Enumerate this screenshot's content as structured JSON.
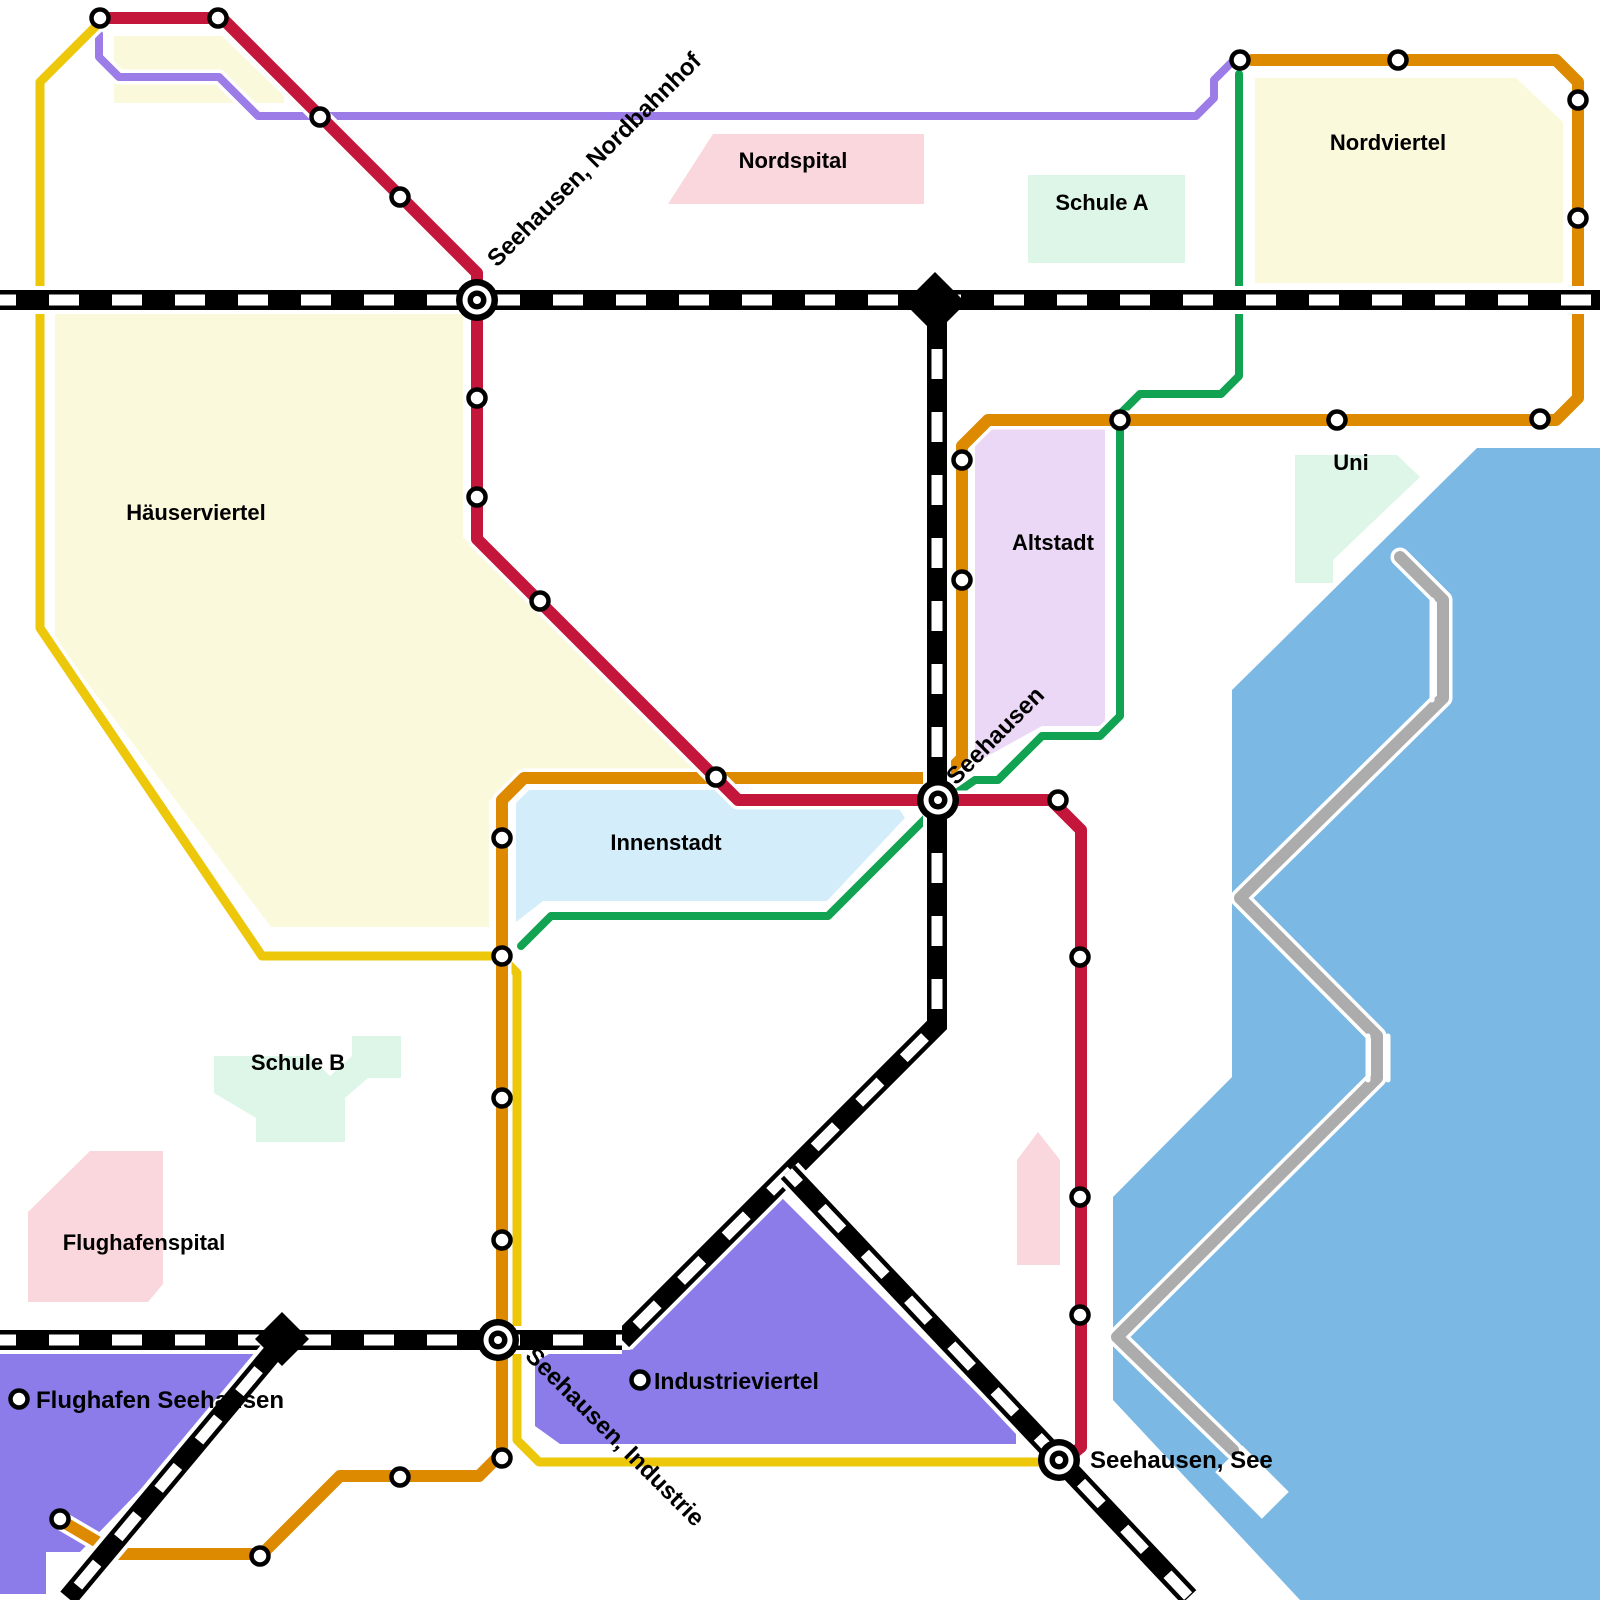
{
  "map": {
    "colors": {
      "line_red": "#C4153A",
      "line_orange": "#DE8A00",
      "line_yellow": "#EDC70A",
      "line_green": "#12A352",
      "line_purple": "#9C7DE8",
      "line_gray": "#ACACAC",
      "railway": "#000000",
      "lake": "#7BB8E3",
      "district_yellow": "#FBF9DC",
      "hospital_pink": "#F9D7DC",
      "school_mint": "#DEF6E8",
      "altstadt_lavender": "#EBD7F6",
      "innenstadt_blue": "#D3EDFA",
      "industrial_violet": "#8B7CEA"
    },
    "regions": [
      {
        "id": "haeuserviertel",
        "label": "Häuserviertel",
        "fill": "district_yellow",
        "label_x": 196,
        "label_y": 520,
        "points": [
          [
            55,
            312
          ],
          [
            463,
            312
          ],
          [
            463,
            537
          ],
          [
            697,
            771
          ],
          [
            697,
            779
          ],
          [
            516,
            779
          ],
          [
            489,
            801
          ],
          [
            489,
            927
          ],
          [
            271,
            927
          ],
          [
            55,
            640
          ]
        ]
      },
      {
        "id": "nordwest-block",
        "label": "",
        "fill": "district_yellow",
        "points": [
          [
            114,
            36
          ],
          [
            222,
            36
          ],
          [
            284,
            96
          ],
          [
            284,
            103
          ],
          [
            114,
            103
          ]
        ]
      },
      {
        "id": "nordviertel",
        "label": "Nordviertel",
        "fill": "district_yellow",
        "label_x": 1388,
        "label_y": 150,
        "points": [
          [
            1255,
            78
          ],
          [
            1516,
            78
          ],
          [
            1563,
            122
          ],
          [
            1563,
            283
          ],
          [
            1255,
            283
          ]
        ]
      },
      {
        "id": "nordspital",
        "label": "Nordspital",
        "fill": "hospital_pink",
        "label_x": 793,
        "label_y": 168,
        "points": [
          [
            713,
            134
          ],
          [
            924,
            134
          ],
          [
            924,
            204
          ],
          [
            668,
            204
          ]
        ]
      },
      {
        "id": "schule-a",
        "label": "Schule A",
        "fill": "school_mint",
        "label_x": 1102,
        "label_y": 210,
        "points": [
          [
            1028,
            175
          ],
          [
            1185,
            175
          ],
          [
            1185,
            263
          ],
          [
            1028,
            263
          ]
        ]
      },
      {
        "id": "uni",
        "label": "Uni",
        "fill": "school_mint",
        "label_x": 1351,
        "label_y": 470,
        "points": [
          [
            1295,
            455
          ],
          [
            1397,
            455
          ],
          [
            1420,
            477
          ],
          [
            1333,
            560
          ],
          [
            1333,
            583
          ],
          [
            1295,
            583
          ]
        ]
      },
      {
        "id": "altstadt",
        "label": "Altstadt",
        "fill": "altstadt_lavender",
        "label_x": 1053,
        "label_y": 550,
        "points": [
          [
            975,
            428
          ],
          [
            1105,
            428
          ],
          [
            1105,
            726
          ],
          [
            1042,
            726
          ],
          [
            975,
            763
          ]
        ]
      },
      {
        "id": "innenstadt",
        "label": "Innenstadt",
        "fill": "innenstadt_blue",
        "label_x": 666,
        "label_y": 850,
        "points": [
          [
            529,
            790
          ],
          [
            725,
            790
          ],
          [
            740,
            807
          ],
          [
            898,
            807
          ],
          [
            905,
            818
          ],
          [
            827,
            901
          ],
          [
            543,
            901
          ],
          [
            516,
            922
          ],
          [
            516,
            803
          ]
        ]
      },
      {
        "id": "schule-b",
        "label": "Schule B",
        "fill": "school_mint",
        "label_x": 298,
        "label_y": 1070,
        "points": [
          [
            214,
            1056
          ],
          [
            310,
            1056
          ],
          [
            330,
            1076
          ],
          [
            352,
            1056
          ],
          [
            352,
            1036
          ],
          [
            401,
            1036
          ],
          [
            401,
            1078
          ],
          [
            368,
            1078
          ],
          [
            345,
            1098
          ],
          [
            345,
            1142
          ],
          [
            256,
            1142
          ],
          [
            256,
            1118
          ],
          [
            214,
            1093
          ]
        ]
      },
      {
        "id": "flughafenspital",
        "label": "Flughafenspital",
        "fill": "hospital_pink",
        "label_x": 144,
        "label_y": 1250,
        "points": [
          [
            90,
            1151
          ],
          [
            163,
            1151
          ],
          [
            163,
            1284
          ],
          [
            148,
            1302
          ],
          [
            28,
            1302
          ],
          [
            28,
            1212
          ]
        ]
      },
      {
        "id": "suedspital-block",
        "label": "",
        "fill": "hospital_pink",
        "points": [
          [
            1017,
            1160
          ],
          [
            1038,
            1132
          ],
          [
            1060,
            1160
          ],
          [
            1060,
            1265
          ],
          [
            1017,
            1265
          ]
        ]
      },
      {
        "id": "industrieviertel",
        "label": "",
        "fill": "industrial_violet",
        "points": [
          [
            782,
            1198
          ],
          [
            1016,
            1432
          ],
          [
            1016,
            1444
          ],
          [
            560,
            1444
          ],
          [
            535,
            1426
          ],
          [
            535,
            1362
          ],
          [
            556,
            1350
          ],
          [
            630,
            1350
          ]
        ]
      },
      {
        "id": "flughafen-areal",
        "label": "",
        "fill": "industrial_violet",
        "points": [
          [
            0,
            1354
          ],
          [
            272,
            1354
          ],
          [
            80,
            1552
          ],
          [
            46,
            1552
          ],
          [
            46,
            1594
          ],
          [
            0,
            1594
          ]
        ]
      },
      {
        "id": "see",
        "label": "",
        "fill": "lake",
        "points": [
          [
            1477,
            448
          ],
          [
            1600,
            448
          ],
          [
            1600,
            1600
          ],
          [
            1300,
            1600
          ],
          [
            1113,
            1400
          ],
          [
            1113,
            1197
          ],
          [
            1232,
            1077
          ],
          [
            1232,
            690
          ]
        ]
      }
    ],
    "lake_notch": {
      "x": 1252,
      "y": 1482,
      "w": 38,
      "h": 66,
      "rot": -45
    },
    "lines": [
      {
        "id": "purple",
        "color": "line_purple",
        "width": 8,
        "points": [
          [
            99,
            34
          ],
          [
            99,
            57
          ],
          [
            119,
            77
          ],
          [
            219,
            77
          ],
          [
            258,
            116
          ],
          [
            1196,
            116
          ],
          [
            1214,
            98
          ],
          [
            1214,
            80
          ],
          [
            1236,
            58
          ]
        ]
      },
      {
        "id": "green",
        "color": "line_green",
        "width": 8,
        "points": [
          [
            1239,
            74
          ],
          [
            1239,
            376
          ],
          [
            1221,
            394
          ],
          [
            1140,
            394
          ],
          [
            1120,
            414
          ],
          [
            1120,
            716
          ],
          [
            1100,
            736
          ],
          [
            1042,
            736
          ],
          [
            998,
            780
          ],
          [
            975,
            780
          ],
          [
            938,
            806
          ],
          [
            828,
            916
          ],
          [
            551,
            916
          ],
          [
            521,
            946
          ]
        ]
      },
      {
        "id": "yellow",
        "color": "line_yellow",
        "width": 9,
        "points": [
          [
            100,
            22
          ],
          [
            40,
            82
          ],
          [
            40,
            628
          ],
          [
            262,
            956
          ],
          [
            500,
            956
          ],
          [
            517,
            973
          ],
          [
            517,
            1440
          ],
          [
            539,
            1462
          ],
          [
            1048,
            1462
          ]
        ]
      },
      {
        "id": "gray",
        "color": "line_gray",
        "width": 12,
        "points": [
          [
            1400,
            557
          ],
          [
            1443,
            600
          ],
          [
            1443,
            698
          ],
          [
            1240,
            898
          ],
          [
            1377,
            1036
          ],
          [
            1377,
            1078
          ],
          [
            1117,
            1337
          ],
          [
            1233,
            1450
          ]
        ]
      },
      {
        "id": "orange",
        "color": "line_orange",
        "width": 12,
        "points": [
          [
            1252,
            60
          ],
          [
            1556,
            60
          ],
          [
            1578,
            82
          ],
          [
            1578,
            398
          ],
          [
            1556,
            420
          ],
          [
            988,
            420
          ],
          [
            962,
            446
          ],
          [
            962,
            758
          ],
          [
            942,
            778
          ],
          [
            524,
            778
          ],
          [
            502,
            800
          ],
          [
            502,
            1453
          ],
          [
            479,
            1476
          ],
          [
            340,
            1476
          ],
          [
            262,
            1554
          ],
          [
            118,
            1554
          ],
          [
            60,
            1520
          ]
        ]
      },
      {
        "id": "red",
        "color": "line_red",
        "width": 12,
        "points": [
          [
            100,
            18
          ],
          [
            222,
            18
          ],
          [
            477,
            273
          ],
          [
            477,
            539
          ],
          [
            738,
            800
          ],
          [
            1051,
            800
          ],
          [
            1081,
            830
          ],
          [
            1081,
            1447
          ],
          [
            1070,
            1456
          ]
        ]
      }
    ],
    "white_marks": [
      {
        "points": [
          [
            1432,
            600
          ],
          [
            1432,
            700
          ]
        ]
      },
      {
        "points": [
          [
            1368,
            1036
          ],
          [
            1368,
            1080
          ]
        ]
      },
      {
        "points": [
          [
            1388,
            1036
          ],
          [
            1388,
            1080
          ]
        ]
      }
    ],
    "railways": [
      {
        "id": "hauptstrecke-nord",
        "points": [
          [
            0,
            300
          ],
          [
            1600,
            300
          ]
        ]
      },
      {
        "id": "vertikalstrecke",
        "points": [
          [
            937,
            300
          ],
          [
            937,
            1025
          ],
          [
            622,
            1340
          ]
        ]
      },
      {
        "id": "seestrecke",
        "points": [
          [
            788,
            1172
          ],
          [
            1189,
            1597
          ]
        ]
      },
      {
        "id": "suedstrecke",
        "points": [
          [
            0,
            1340
          ],
          [
            622,
            1340
          ]
        ]
      },
      {
        "id": "flughafenstrecke",
        "points": [
          [
            290,
            1332
          ],
          [
            68,
            1598
          ]
        ]
      }
    ],
    "rail_junction_diamonds": [
      {
        "x": 935,
        "y": 303,
        "r": 31
      },
      {
        "x": 282,
        "y": 1339,
        "r": 27
      }
    ],
    "interchanges": [
      {
        "id": "seehausen-nordbahnhof",
        "x": 477,
        "y": 300
      },
      {
        "id": "seehausen",
        "x": 938,
        "y": 800
      },
      {
        "id": "seehausen-industrie",
        "x": 498,
        "y": 1340
      },
      {
        "id": "seehausen-see",
        "x": 1059,
        "y": 1460
      }
    ],
    "stations": [
      {
        "x": 100,
        "y": 18
      },
      {
        "x": 218,
        "y": 18
      },
      {
        "x": 320,
        "y": 117
      },
      {
        "x": 400,
        "y": 197
      },
      {
        "x": 477,
        "y": 398
      },
      {
        "x": 477,
        "y": 497
      },
      {
        "x": 540,
        "y": 601
      },
      {
        "x": 716,
        "y": 777
      },
      {
        "x": 1058,
        "y": 800
      },
      {
        "x": 1080,
        "y": 957
      },
      {
        "x": 1080,
        "y": 1197
      },
      {
        "x": 1080,
        "y": 1315
      },
      {
        "x": 1240,
        "y": 60
      },
      {
        "x": 1398,
        "y": 60
      },
      {
        "x": 1578,
        "y": 100
      },
      {
        "x": 1578,
        "y": 218
      },
      {
        "x": 1540,
        "y": 419
      },
      {
        "x": 1337,
        "y": 420
      },
      {
        "x": 1120,
        "y": 420
      },
      {
        "x": 962,
        "y": 460
      },
      {
        "x": 962,
        "y": 580
      },
      {
        "x": 502,
        "y": 838
      },
      {
        "x": 502,
        "y": 956
      },
      {
        "x": 502,
        "y": 1098
      },
      {
        "x": 502,
        "y": 1240
      },
      {
        "x": 502,
        "y": 1458
      },
      {
        "x": 400,
        "y": 1477
      },
      {
        "x": 260,
        "y": 1556
      },
      {
        "x": 60,
        "y": 1519
      },
      {
        "x": 640,
        "y": 1380
      },
      {
        "x": 19,
        "y": 1399
      }
    ],
    "station_labels": [
      {
        "id": "label-seehausen-nordbahnhof",
        "text": "Seehausen, Nordbahnhof",
        "x": 497,
        "y": 268,
        "rotate": -45,
        "anchor": "start",
        "size": 24
      },
      {
        "id": "label-seehausen",
        "text": "Seehausen",
        "x": 956,
        "y": 786,
        "rotate": -45,
        "anchor": "start",
        "size": 24
      },
      {
        "id": "label-seehausen-industrie",
        "text": "Seehausen, Industrie",
        "x": 524,
        "y": 1357,
        "rotate": 45,
        "anchor": "start",
        "size": 24
      },
      {
        "id": "label-seehausen-see",
        "text": "Seehausen, See",
        "x": 1090,
        "y": 1468,
        "rotate": 0,
        "anchor": "start",
        "size": 24
      },
      {
        "id": "label-flughafen-seehausen",
        "text": "Flughafen Seehausen",
        "x": 36,
        "y": 1408,
        "rotate": 0,
        "anchor": "start",
        "size": 24
      },
      {
        "id": "label-industrieviertel",
        "text": "Industrieviertel",
        "x": 654,
        "y": 1389,
        "rotate": 0,
        "anchor": "start",
        "size": 23
      }
    ]
  }
}
